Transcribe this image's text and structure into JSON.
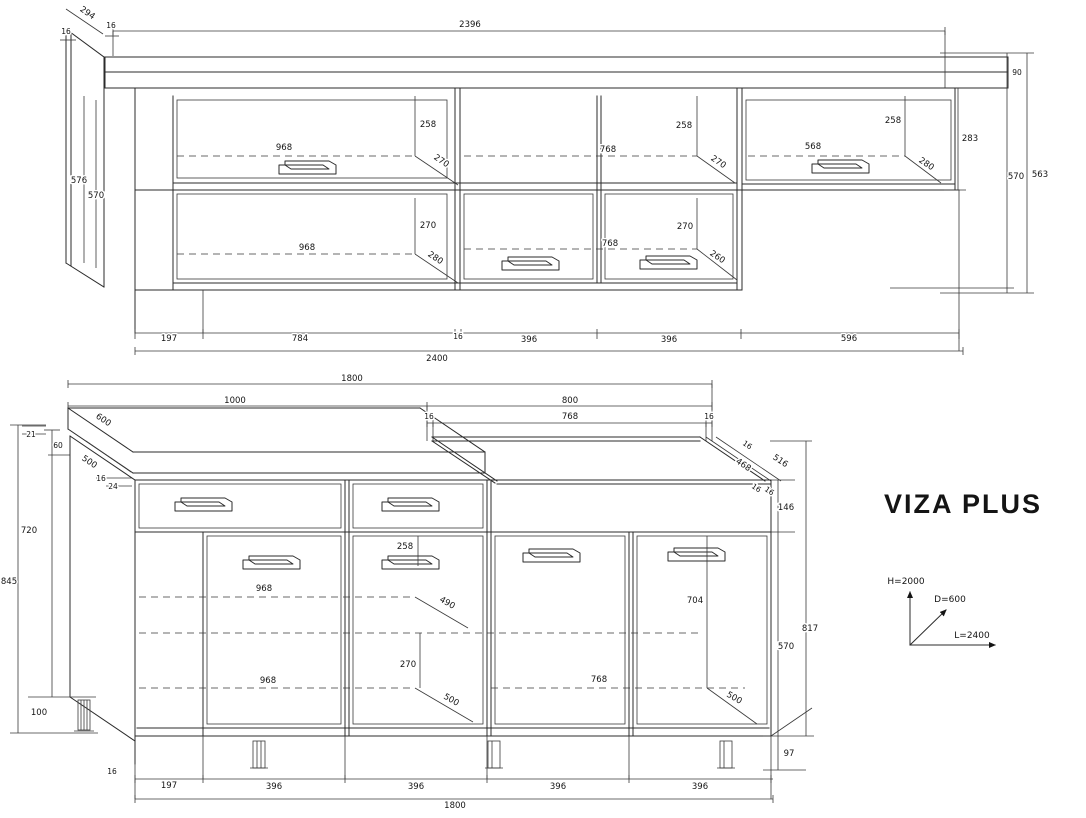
{
  "title": "VIZA PLUS",
  "colors": {
    "line": "#2b2b2b",
    "text": "#141414",
    "background": "#ffffff"
  },
  "axis_legend": {
    "height": "H=2000",
    "depth": "D=600",
    "length": "L=2400"
  },
  "top_view": {
    "name": "wall-cabinets-elevation",
    "dims": {
      "d294": "294",
      "t16a": "16",
      "t16b": "16",
      "w2396": "2396",
      "h90": "90",
      "side_h576": "576",
      "side_h570": "570",
      "g1_h258": "258",
      "g1_w968a": "968",
      "g1_d270a": "270",
      "g1_d270b": "270",
      "g1_w968b": "968",
      "g1_d280": "280",
      "g2_h258": "258",
      "g2_w768a": "768",
      "g2_d270a": "270",
      "g2_d270b": "270",
      "g2_w768b": "768",
      "g2_d260": "260",
      "g3_h258": "258",
      "g3_w568": "568",
      "g3_d280": "280",
      "g3_h283": "283",
      "right_h570": "570",
      "right_h563": "563",
      "b197": "197",
      "b784": "784",
      "b16": "16",
      "b396a": "396",
      "b396b": "396",
      "b596": "596",
      "total": "2400"
    }
  },
  "bottom_view": {
    "name": "base-cabinets-perspective",
    "dims": {
      "top1800": "1800",
      "w1000": "1000",
      "w800": "800",
      "t16a": "16",
      "w768a": "768",
      "t16b": "16",
      "d600": "600",
      "t21": "21",
      "t60": "60",
      "d500a": "500",
      "t16c": "16",
      "t24": "24",
      "t16d": "16",
      "d468": "468",
      "d516": "516",
      "t16e": "16",
      "t16f": "16",
      "h146": "146",
      "h720": "720",
      "h845": "845",
      "h100": "100",
      "h258": "258",
      "w968a": "968",
      "d490": "490",
      "h270": "270",
      "w968b": "968",
      "d500b": "500",
      "h704": "704",
      "w768b": "768",
      "d500c": "500",
      "h570": "570",
      "h817": "817",
      "h97": "97",
      "t16g": "16",
      "b197": "197",
      "b396a": "396",
      "b396b": "396",
      "b396c": "396",
      "b396d": "396",
      "total": "1800"
    }
  }
}
